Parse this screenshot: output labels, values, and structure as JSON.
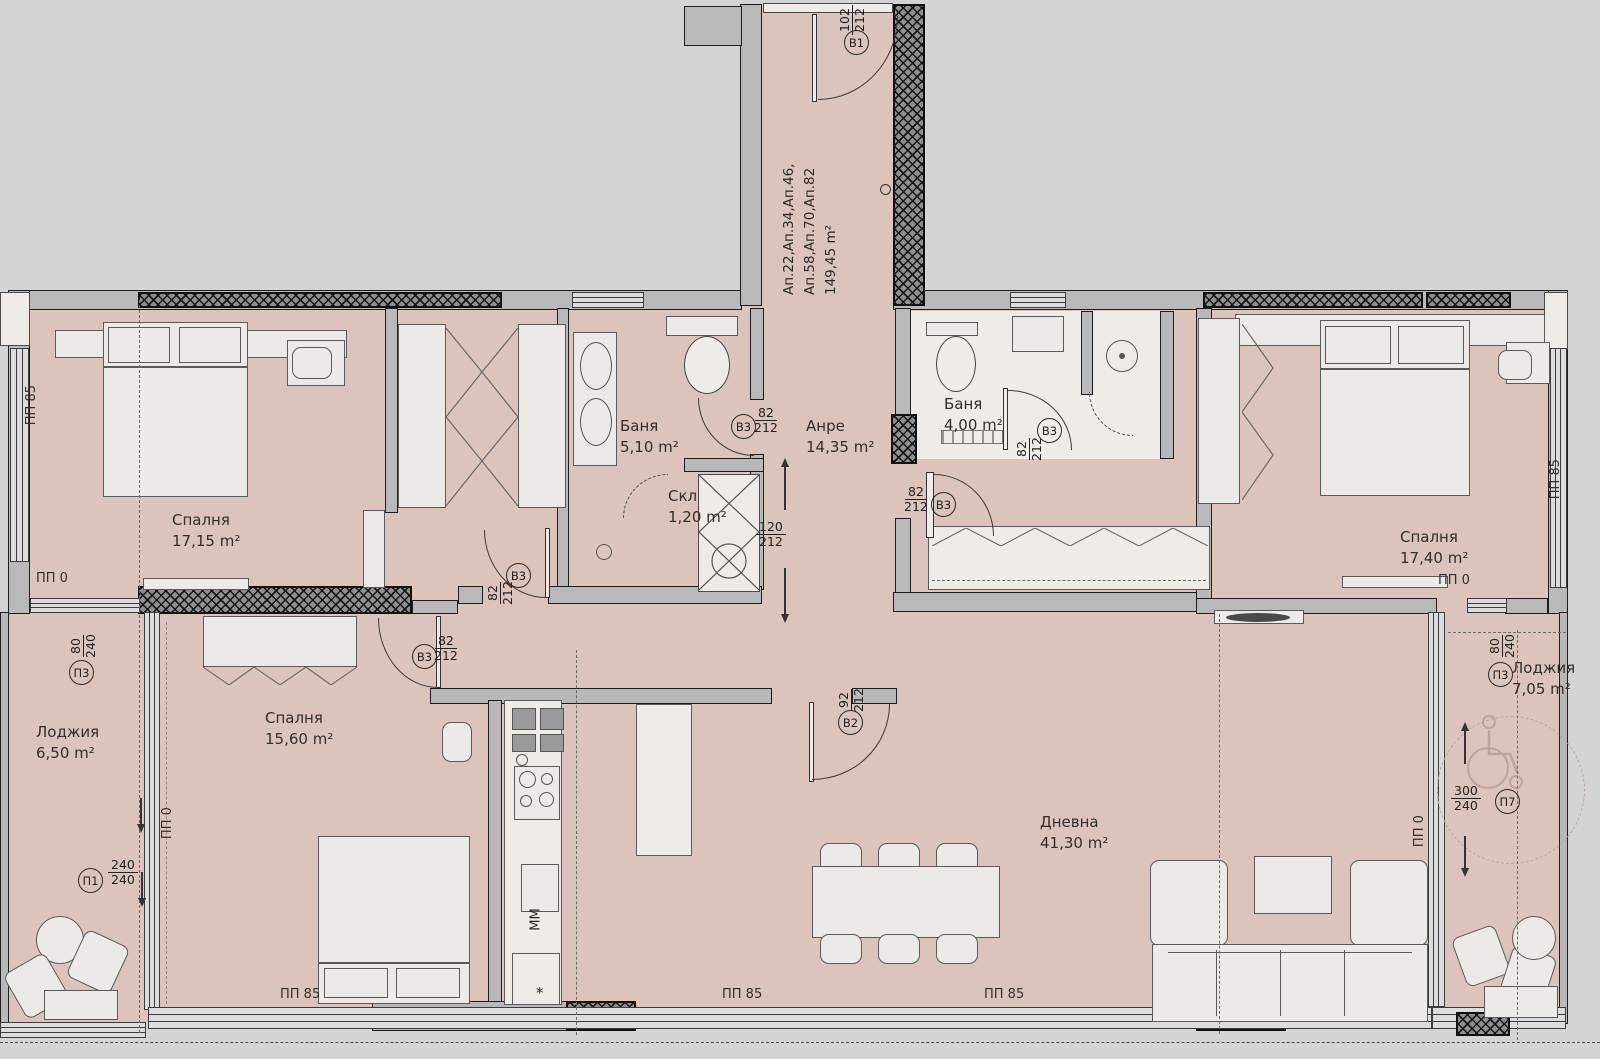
{
  "apartment": {
    "line1": "Ап.22,Ап.34,Ап.46,",
    "line2": "Ап.58,Ап.70,Ап.82",
    "area": "149,45 m²"
  },
  "rooms": {
    "bedroom_left": {
      "name": "Спалня",
      "area": "17,15 m²"
    },
    "bedroom_mid": {
      "name": "Спалня",
      "area": "15,60 m²"
    },
    "bedroom_right": {
      "name": "Спалня",
      "area": "17,40 m²"
    },
    "bath_main": {
      "name": "Баня",
      "area": "5,10 m²"
    },
    "bath_small": {
      "name": "Баня",
      "area": "4,00 m²"
    },
    "storage": {
      "name": "Скл",
      "area": "1,20 m²"
    },
    "hall": {
      "name": "Анре",
      "area": "14,35 m²"
    },
    "living": {
      "name": "Дневна",
      "area": "41,30 m²"
    },
    "loggia_left": {
      "name": "Лоджия",
      "area": "6,50 m²"
    },
    "loggia_right": {
      "name": "Лоджия",
      "area": "7,05 m²"
    }
  },
  "doors": {
    "entrance": {
      "tag": "B1",
      "w": "102",
      "h": "212"
    },
    "living": {
      "tag": "B2",
      "w": "92",
      "h": "212"
    },
    "bath_main": {
      "tag": "B3",
      "w": "82",
      "h": "212"
    },
    "lobby": {
      "tag": "B3",
      "w": "82",
      "h": "212"
    },
    "bedroom_mid": {
      "tag": "B3",
      "w": "82",
      "h": "212"
    },
    "hall_right": {
      "tag": "B3",
      "w": "82",
      "h": "212"
    },
    "bath_small": {
      "tag": "B3",
      "w": "82",
      "h": "212"
    }
  },
  "windows": {
    "loggia_left_door": {
      "tag": "П3",
      "w": "80",
      "h": "240"
    },
    "loggia_left_win": {
      "tag": "П1",
      "w": "240",
      "h": "240"
    },
    "loggia_right_door": {
      "tag": "П3",
      "w": "80",
      "h": "240"
    },
    "loggia_right_win": {
      "tag": "П7",
      "w": "300",
      "h": "240"
    }
  },
  "shaft": {
    "w": "120",
    "h": "212"
  },
  "marks": {
    "pp85": "ПП 85",
    "pp0": "ПП 0"
  },
  "kitchen": {
    "mm": "ММ",
    "star": "*"
  }
}
